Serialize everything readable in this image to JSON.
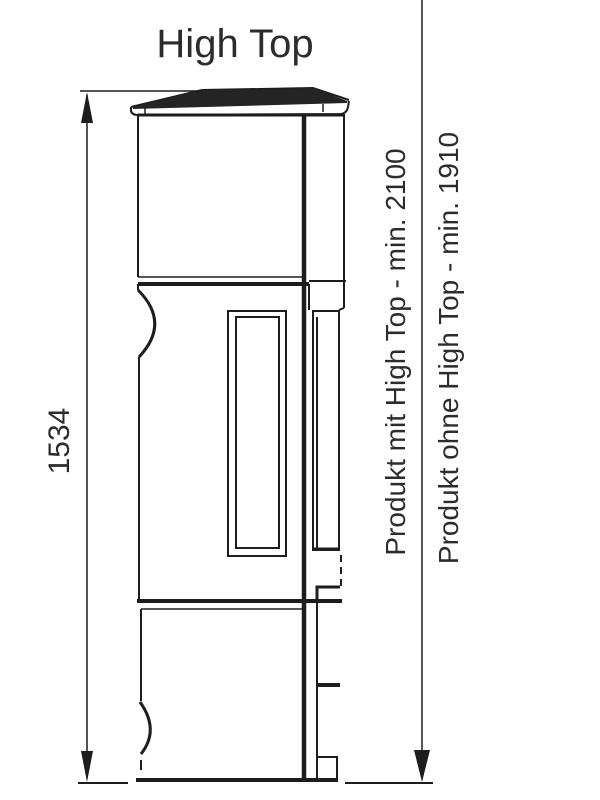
{
  "title": "High Top",
  "labels": {
    "height": "1534",
    "with_high_top": "Produkt mit High Top - min. 2100",
    "without_high_top": "Produkt ohne High Top - min. 1910"
  },
  "colors": {
    "line": "#1d1d1d",
    "text": "#2c2c2c",
    "background": "#ffffff"
  }
}
